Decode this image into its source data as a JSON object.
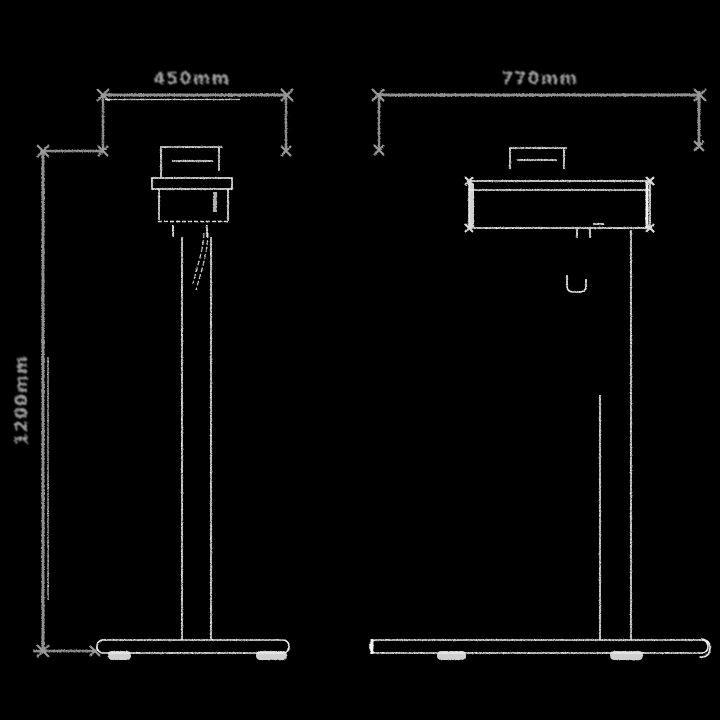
{
  "diagram": {
    "front": {
      "width_label": "450mm",
      "height_label": "1200mm"
    },
    "side": {
      "depth_label": "770mm"
    },
    "colors": {
      "background": "#000000",
      "dimension_line": "#8f8f8f",
      "label_text": "#9b9b9b",
      "product_outline": "#ededed"
    }
  }
}
